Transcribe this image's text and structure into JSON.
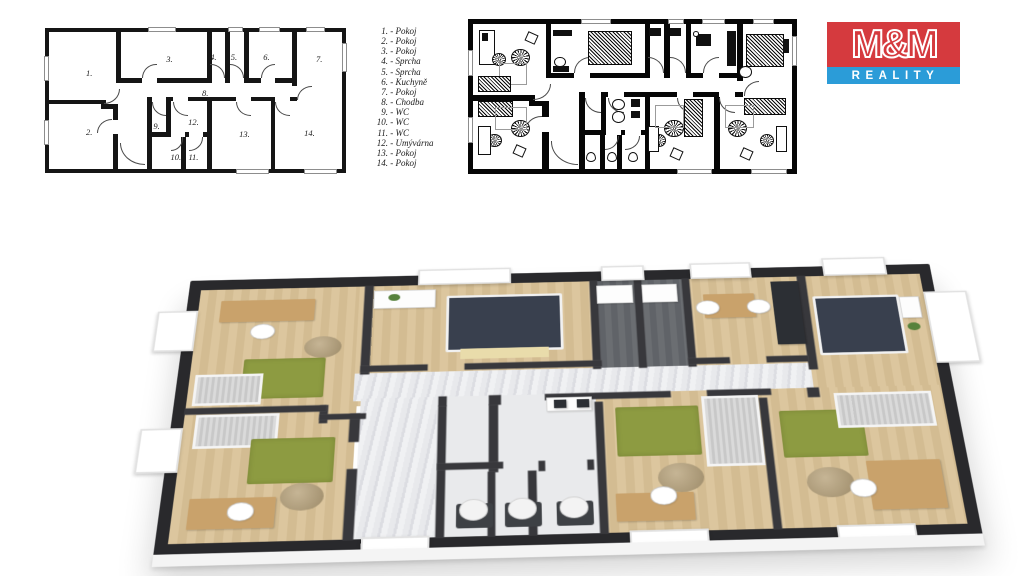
{
  "legend": {
    "separator": " - ",
    "items": [
      {
        "num": "1.",
        "name": "Pokoj"
      },
      {
        "num": "2.",
        "name": "Pokoj"
      },
      {
        "num": "3.",
        "name": "Pokoj"
      },
      {
        "num": "4.",
        "name": "Sprcha"
      },
      {
        "num": "5.",
        "name": "Sprcha"
      },
      {
        "num": "6.",
        "name": "Kuchyně"
      },
      {
        "num": "7.",
        "name": "Pokoj"
      },
      {
        "num": "8.",
        "name": "Chodba"
      },
      {
        "num": "9.",
        "name": "WC"
      },
      {
        "num": "10.",
        "name": "WC"
      },
      {
        "num": "11.",
        "name": "WC"
      },
      {
        "num": "12.",
        "name": "Umývárna"
      },
      {
        "num": "13.",
        "name": "Pokoj"
      },
      {
        "num": "14.",
        "name": "Pokoj"
      }
    ]
  },
  "logo": {
    "title": "M&M",
    "subtitle": "REALITY",
    "brand_red": "#d53a3e",
    "brand_blue": "#2b9cd8"
  },
  "colors": {
    "wall_dark": "#29292c",
    "wood_floor": "#d8c096",
    "rug_green": "#8d9b41",
    "corridor_gray": "#e6e7ea",
    "shower_tile": "#6b6e72",
    "background": "#ffffff"
  }
}
